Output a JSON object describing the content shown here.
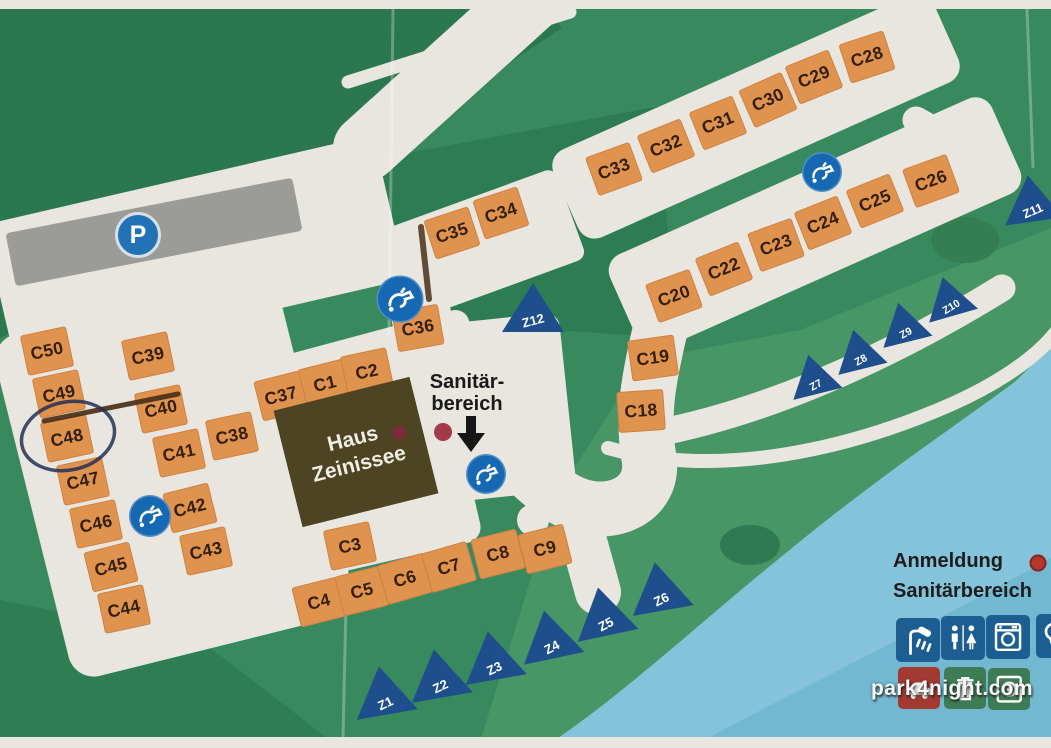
{
  "colors": {
    "grass": "#38895e",
    "grass_dark": "#2b7850",
    "path": "#e9e6df",
    "water": "#84c3da",
    "campsite": "#e0924f",
    "campsite_text": "#33200e",
    "tent": "#1e4e8c",
    "tap_circle": "#1668b3",
    "parking": "#2273b5",
    "building": "#4c4423",
    "legend_red": "#b5372e",
    "sanitaer_red": "#a23a4a",
    "pen_blue": "#252f55",
    "pen_brown": "#4a3018"
  },
  "campsites": [
    {
      "label": "C1",
      "x": 325,
      "y": 384,
      "r": -14
    },
    {
      "label": "C2",
      "x": 367,
      "y": 372,
      "r": -12
    },
    {
      "label": "C3",
      "x": 350,
      "y": 546,
      "r": -12
    },
    {
      "label": "C4",
      "x": 319,
      "y": 602,
      "r": -14
    },
    {
      "label": "C5",
      "x": 362,
      "y": 591,
      "r": -14
    },
    {
      "label": "C6",
      "x": 405,
      "y": 579,
      "r": -16
    },
    {
      "label": "C7",
      "x": 449,
      "y": 567,
      "r": -16
    },
    {
      "label": "C8",
      "x": 498,
      "y": 554,
      "r": -14
    },
    {
      "label": "C9",
      "x": 545,
      "y": 549,
      "r": -14
    },
    {
      "label": "C18",
      "x": 641,
      "y": 411,
      "r": -4
    },
    {
      "label": "C19",
      "x": 653,
      "y": 358,
      "r": -8
    },
    {
      "label": "C20",
      "x": 674,
      "y": 296,
      "r": -20
    },
    {
      "label": "C22",
      "x": 724,
      "y": 269,
      "r": -22
    },
    {
      "label": "C23",
      "x": 776,
      "y": 245,
      "r": -20
    },
    {
      "label": "C24",
      "x": 823,
      "y": 223,
      "r": -22
    },
    {
      "label": "C25",
      "x": 875,
      "y": 201,
      "r": -22
    },
    {
      "label": "C26",
      "x": 931,
      "y": 181,
      "r": -20
    },
    {
      "label": "C28",
      "x": 867,
      "y": 57,
      "r": -18
    },
    {
      "label": "C29",
      "x": 814,
      "y": 77,
      "r": -22
    },
    {
      "label": "C30",
      "x": 768,
      "y": 100,
      "r": -24
    },
    {
      "label": "C31",
      "x": 718,
      "y": 123,
      "r": -22
    },
    {
      "label": "C32",
      "x": 666,
      "y": 146,
      "r": -22
    },
    {
      "label": "C33",
      "x": 614,
      "y": 169,
      "r": -20
    },
    {
      "label": "C34",
      "x": 501,
      "y": 213,
      "r": -18
    },
    {
      "label": "C35",
      "x": 452,
      "y": 233,
      "r": -18
    },
    {
      "label": "C36",
      "x": 418,
      "y": 328,
      "r": -10
    },
    {
      "label": "C37",
      "x": 281,
      "y": 396,
      "r": -14
    },
    {
      "label": "C38",
      "x": 232,
      "y": 436,
      "r": -12
    },
    {
      "label": "C39",
      "x": 148,
      "y": 356,
      "r": -12
    },
    {
      "label": "C40",
      "x": 161,
      "y": 409,
      "r": -12
    },
    {
      "label": "C41",
      "x": 179,
      "y": 453,
      "r": -12
    },
    {
      "label": "C42",
      "x": 190,
      "y": 508,
      "r": -14
    },
    {
      "label": "C43",
      "x": 206,
      "y": 551,
      "r": -12
    },
    {
      "label": "C44",
      "x": 124,
      "y": 609,
      "r": -12
    },
    {
      "label": "C45",
      "x": 111,
      "y": 567,
      "r": -14
    },
    {
      "label": "C46",
      "x": 96,
      "y": 524,
      "r": -12
    },
    {
      "label": "C47",
      "x": 83,
      "y": 481,
      "r": -12
    },
    {
      "label": "C48",
      "x": 67,
      "y": 438,
      "r": -12
    },
    {
      "label": "C49",
      "x": 59,
      "y": 394,
      "r": -12
    },
    {
      "label": "C50",
      "x": 47,
      "y": 351,
      "r": -12
    }
  ],
  "tents": [
    {
      "label": "Z1",
      "x": 383,
      "y": 690,
      "r": -10
    },
    {
      "label": "Z2",
      "x": 438,
      "y": 673,
      "r": -10
    },
    {
      "label": "Z3",
      "x": 492,
      "y": 655,
      "r": -10
    },
    {
      "label": "Z4",
      "x": 549,
      "y": 634,
      "r": -12
    },
    {
      "label": "Z5",
      "x": 603,
      "y": 611,
      "r": -12
    },
    {
      "label": "Z6",
      "x": 659,
      "y": 586,
      "r": -10
    },
    {
      "label": "Z7",
      "x": 813,
      "y": 374,
      "r": -14,
      "s": 0.82
    },
    {
      "label": "Z8",
      "x": 858,
      "y": 349,
      "r": -14,
      "s": 0.82
    },
    {
      "label": "Z9",
      "x": 903,
      "y": 322,
      "r": -14,
      "s": 0.82
    },
    {
      "label": "Z10",
      "x": 948,
      "y": 296,
      "r": -16,
      "s": 0.82
    },
    {
      "label": "Z11",
      "x": 1031,
      "y": 198,
      "r": -8,
      "s": 0.95
    },
    {
      "label": "Z12",
      "x": 533,
      "y": 307,
      "r": 0
    }
  ],
  "taps": [
    {
      "x": 400,
      "y": 299,
      "d": 47
    },
    {
      "x": 150,
      "y": 516,
      "d": 42
    },
    {
      "x": 822,
      "y": 172,
      "d": 40
    },
    {
      "x": 486,
      "y": 474,
      "d": 40
    }
  ],
  "parking": {
    "label": "P",
    "x": 138,
    "y": 235
  },
  "haus": {
    "line1": "Haus",
    "line2": "Zeinissee",
    "x": 356,
    "y": 452,
    "r": -14
  },
  "haus_dot": {
    "x": 399,
    "y": 433
  },
  "sanitaer": {
    "line1": "Sanitär-",
    "line2": "bereich",
    "x": 467,
    "y": 393
  },
  "sanitaer_dot": {
    "x": 443,
    "y": 432
  },
  "sanitaer_arrow": {
    "x": 471,
    "y": 434
  },
  "legend": {
    "anmeldung": "Anmeldung",
    "sanitaerbereich": "Sanitärbereich",
    "anmeldung_dot": {
      "x": 1038,
      "y": 563
    }
  },
  "facility_icons_row1": [
    "shower",
    "toilets",
    "washing-machine",
    "hairdryer"
  ],
  "facility_icons_row2": [
    "car",
    "trash",
    "dryer"
  ],
  "annotations": {
    "circled_site": "C48",
    "pen_line": "handwritten line from C48 toward C40"
  },
  "watermark": {
    "text": "park4night.com",
    "x": 952,
    "y": 689
  }
}
